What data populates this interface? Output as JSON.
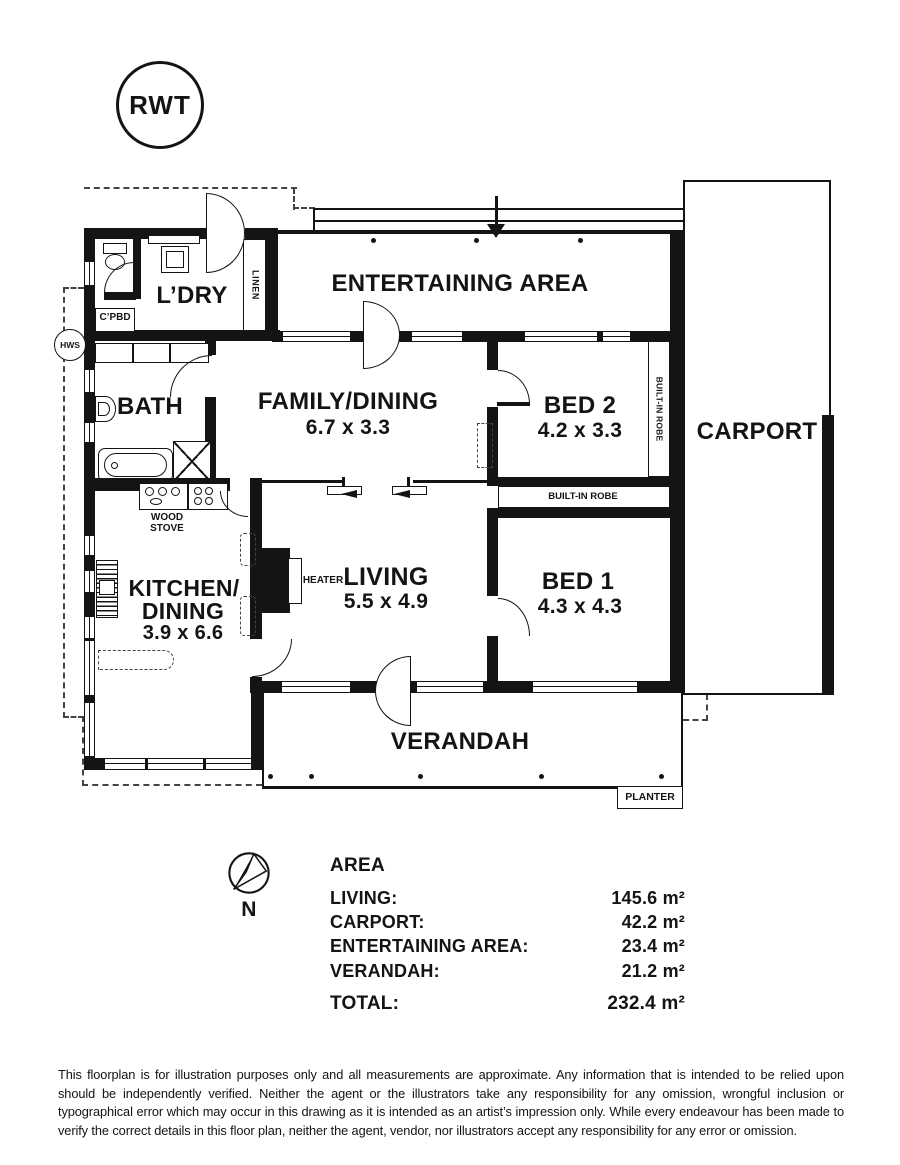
{
  "rwt": {
    "label": "RWT"
  },
  "compass": {
    "label": "N"
  },
  "rooms": {
    "entertaining": {
      "name": "ENTERTAINING AREA"
    },
    "family": {
      "name": "FAMILY/DINING",
      "dims": "6.7 x 3.3"
    },
    "bed2": {
      "name": "BED 2",
      "dims": "4.2 x 3.3"
    },
    "carport": {
      "name": "CARPORT"
    },
    "ldry": {
      "name": "L’DRY"
    },
    "bath": {
      "name": "BATH"
    },
    "kitchen": {
      "name_line1": "KITCHEN/",
      "name_line2": "DINING",
      "dims": "3.9 x 6.6"
    },
    "living": {
      "name": "LIVING",
      "dims": "5.5 x 4.9"
    },
    "bed1": {
      "name": "BED 1",
      "dims": "4.3 x 4.3"
    },
    "verandah": {
      "name": "VERANDAH"
    }
  },
  "features": {
    "linen": "LINEN",
    "cpbd": "C’PBD",
    "hws": "HWS",
    "wood_stove_line1": "WOOD",
    "wood_stove_line2": "STOVE",
    "heater": "HEATER",
    "robe_bed2": "BUILT-IN ROBE",
    "robe_bed1": "BUILT-IN ROBE",
    "planter": "PLANTER"
  },
  "area_table": {
    "title": "AREA",
    "rows": [
      {
        "label": "LIVING:",
        "value": "145.6 m²"
      },
      {
        "label": "CARPORT:",
        "value": "42.2 m²"
      },
      {
        "label": "ENTERTAINING AREA:",
        "value": "23.4 m²"
      },
      {
        "label": "VERANDAH:",
        "value": "21.2 m²"
      }
    ],
    "total": {
      "label": "TOTAL:",
      "value": "232.4 m²"
    }
  },
  "disclaimer": "This floorplan is for illustration purposes only and all measurements are approximate. Any information that is intended to be relied upon should be independently verified. Neither the agent or the illustrators take any responsibility for any omission, wrongful inclusion or typographical error which may occur in this drawing as it is intended as an artist’s impression only. While every endeavour has been made to verify the correct details in this floor plan, neither the agent, vendor, nor illustrators accept any responsibility for any error or omission.",
  "colors": {
    "ink": "#141414",
    "background": "#ffffff"
  }
}
